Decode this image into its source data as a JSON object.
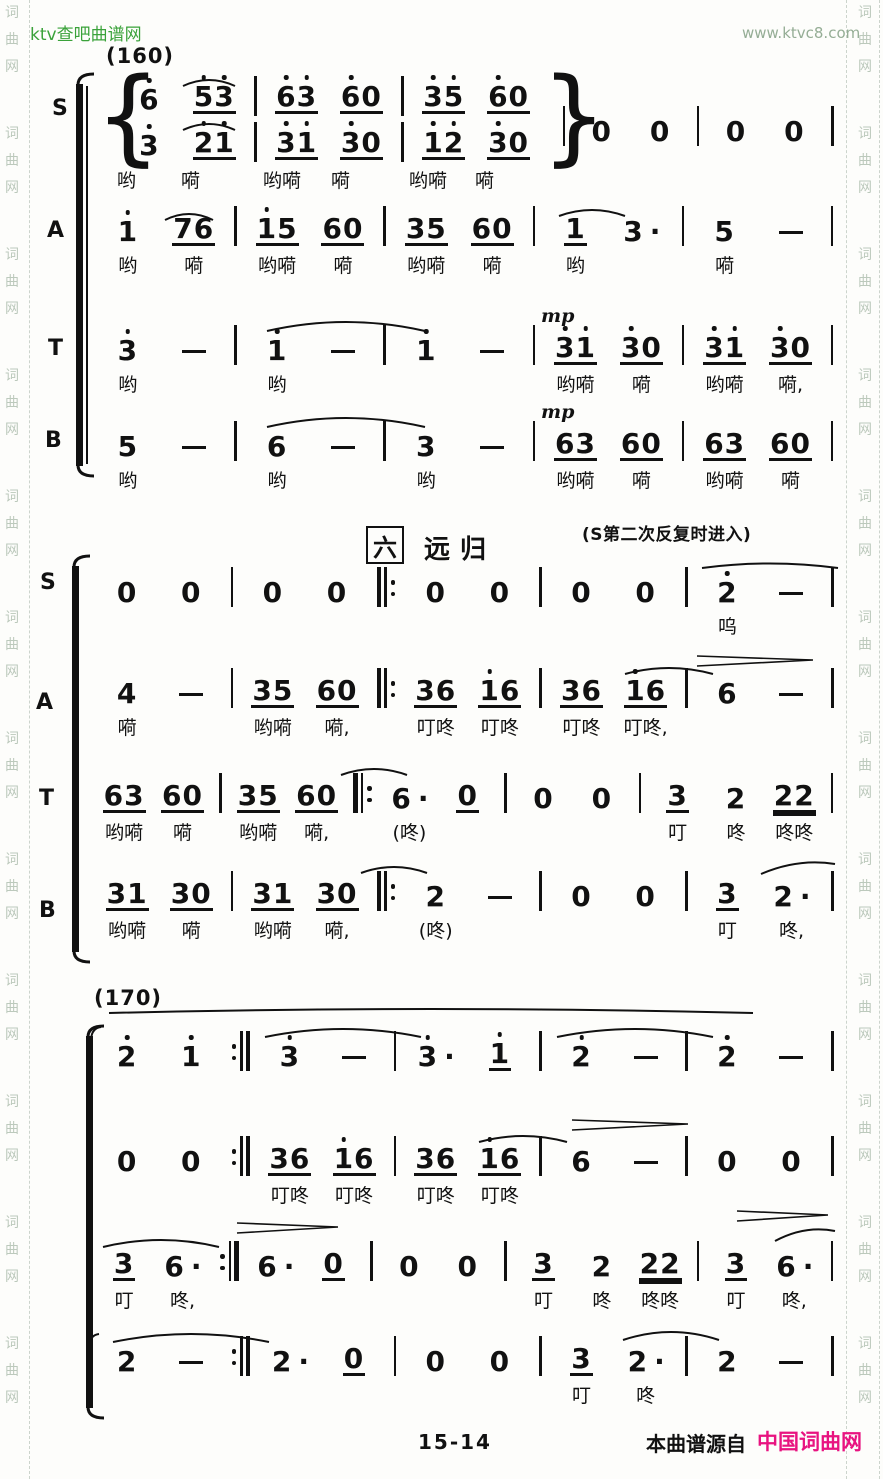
{
  "page": {
    "bg": "#fdfdfb",
    "ink": "#111111",
    "header_green": "#3aa23a",
    "header_sage": "#95ad95",
    "watermark_color": "#bcc9bc",
    "magenta": "#e81380"
  },
  "header": {
    "site_left": "ktv查吧曲谱网",
    "site_right": "www.ktvc8.com"
  },
  "watermark": {
    "chars": [
      "词",
      "曲",
      "网"
    ],
    "groups": 12
  },
  "footer": {
    "page_no": "15-14",
    "source_prefix": "本曲谱源自",
    "source_site": "中国词曲网"
  },
  "dynamics": {
    "mp": "mp"
  },
  "labels": [
    {
      "name": "rehearsal-mark-160",
      "text": "(160)",
      "x": 106,
      "y": 44,
      "cls": "mark"
    },
    {
      "name": "voice-label-s1",
      "text": "S",
      "x": 52,
      "y": 96,
      "cls": "vlabel"
    },
    {
      "name": "voice-label-a1",
      "text": "A",
      "x": 47,
      "y": 218,
      "cls": "vlabel"
    },
    {
      "name": "voice-label-t1",
      "text": "T",
      "x": 48,
      "y": 336,
      "cls": "vlabel"
    },
    {
      "name": "voice-label-b1",
      "text": "B",
      "x": 45,
      "y": 428,
      "cls": "vlabel"
    },
    {
      "name": "section-number-box",
      "text": "六",
      "x": 366,
      "y": 526,
      "cls": "boxed"
    },
    {
      "name": "section-title",
      "text": "远归",
      "x": 424,
      "y": 529,
      "cls": "sect"
    },
    {
      "name": "repeat-annotation",
      "text": "(S第二次反复时进入)",
      "x": 582,
      "y": 520,
      "cls": "annot"
    },
    {
      "name": "voice-label-s2",
      "text": "S",
      "x": 40,
      "y": 570,
      "cls": "vlabel"
    },
    {
      "name": "voice-label-a2",
      "text": "A",
      "x": 36,
      "y": 690,
      "cls": "vlabel"
    },
    {
      "name": "voice-label-t2",
      "text": "T",
      "x": 39,
      "y": 786,
      "cls": "vlabel"
    },
    {
      "name": "voice-label-b2",
      "text": "B",
      "x": 39,
      "y": 898,
      "cls": "vlabel"
    },
    {
      "name": "rehearsal-mark-170",
      "text": "(170)",
      "x": 94,
      "y": 986,
      "cls": "mark"
    }
  ],
  "brackets": [
    {
      "x": 76,
      "y": 84,
      "h": 382,
      "thin": true
    },
    {
      "x": 72,
      "y": 566,
      "h": 386,
      "thin": false
    },
    {
      "x": 86,
      "y": 1036,
      "h": 372,
      "thin": false
    }
  ],
  "divisi": {
    "top": 70,
    "lines": [
      [
        "6'",
        "5'3'_",
        "|",
        "6'3'_",
        "6'0_",
        "|",
        "3'5'_",
        "6'0_"
      ],
      [
        "3'",
        "2'1'_",
        "|",
        "3'1'_",
        "3'0_",
        "|",
        "1'2'_",
        "3'0_"
      ]
    ],
    "after": [
      "|",
      "0",
      "0",
      "|",
      "0",
      "0",
      "|"
    ],
    "lyrics": [
      {
        "x": 0,
        "t": "哟"
      },
      {
        "x": 64,
        "t": "嗬"
      },
      {
        "x": 146,
        "t": "哟嗬"
      },
      {
        "x": 214,
        "t": "嗬"
      },
      {
        "x": 292,
        "t": "哟嗬"
      },
      {
        "x": 358,
        "t": "嗬"
      }
    ],
    "overlays": [
      {
        "type": "tie",
        "x": 64,
        "y": 4,
        "w": 56
      },
      {
        "type": "tie",
        "x": 64,
        "y": 48,
        "w": 56
      }
    ]
  },
  "rows": [
    {
      "voice": "A",
      "top": 200,
      "cells": [
        {
          "t": "1'",
          "l": "哟"
        },
        {
          "t": "76_",
          "l": "嗬"
        },
        {
          "t": "|"
        },
        {
          "t": "1'5_",
          "l": "哟嗬"
        },
        {
          "t": "60_",
          "l": "嗬"
        },
        {
          "t": "|"
        },
        {
          "t": "35_",
          "l": "哟嗬"
        },
        {
          "t": "60_",
          "l": "嗬"
        },
        {
          "t": "|"
        },
        {
          "t": "1_",
          "l": "哟"
        },
        {
          "t": "3."
        },
        {
          "t": "|"
        },
        {
          "t": "5",
          "l": "嗬"
        },
        {
          "t": "-"
        },
        {
          "t": "|"
        }
      ],
      "overlays": [
        {
          "type": "tie",
          "x": 68,
          "y": 8,
          "w": 52
        },
        {
          "type": "tie",
          "x": 462,
          "y": 4,
          "w": 70
        }
      ]
    },
    {
      "voice": "T",
      "top": 319,
      "cells": [
        {
          "t": "3'",
          "l": "哟"
        },
        {
          "t": "-"
        },
        {
          "t": "|"
        },
        {
          "t": "1'",
          "l": "哟"
        },
        {
          "t": "-"
        },
        {
          "t": "|"
        },
        {
          "t": "1'"
        },
        {
          "t": "-"
        },
        {
          "t": "|"
        },
        {
          "t": "3'1'_",
          "l": "哟嗬"
        },
        {
          "t": "3'0_",
          "l": "嗬"
        },
        {
          "t": "|"
        },
        {
          "t": "3'1'_",
          "l": "哟嗬"
        },
        {
          "t": "3'0_",
          "l": "嗬,"
        },
        {
          "t": "|"
        }
      ],
      "overlays": [
        {
          "type": "slur",
          "x": 170,
          "y": -6,
          "w": 162,
          "h": 18
        },
        {
          "type": "mp",
          "x": 446,
          "y": -14
        }
      ]
    },
    {
      "voice": "B",
      "top": 415,
      "cells": [
        {
          "t": "5",
          "l": "哟"
        },
        {
          "t": "-"
        },
        {
          "t": "|"
        },
        {
          "t": "6",
          "l": "哟"
        },
        {
          "t": "-"
        },
        {
          "t": "|"
        },
        {
          "t": "3",
          "l": "哟"
        },
        {
          "t": "-"
        },
        {
          "t": "|"
        },
        {
          "t": "63_",
          "l": "哟嗬"
        },
        {
          "t": "60_",
          "l": "嗬"
        },
        {
          "t": "|"
        },
        {
          "t": "63_",
          "l": "哟嗬"
        },
        {
          "t": "60_",
          "l": "嗬"
        },
        {
          "t": "|"
        }
      ],
      "overlays": [
        {
          "type": "slur",
          "x": 170,
          "y": -6,
          "w": 162,
          "h": 18
        },
        {
          "type": "mp",
          "x": 446,
          "y": -14
        }
      ]
    },
    {
      "voice": "S",
      "top": 561,
      "cells": [
        {
          "t": "0"
        },
        {
          "t": "0"
        },
        {
          "t": "|"
        },
        {
          "t": "0"
        },
        {
          "t": "0"
        },
        {
          "t": "|:"
        },
        {
          "t": "0"
        },
        {
          "t": "0"
        },
        {
          "t": "|"
        },
        {
          "t": "0"
        },
        {
          "t": "0"
        },
        {
          "t": "|"
        },
        {
          "t": "2'",
          "l": "呜"
        },
        {
          "t": "-"
        },
        {
          "t": "|"
        }
      ],
      "overlays": [
        {
          "type": "flat",
          "x": 605,
          "y": -2,
          "w": 140,
          "h": 9
        }
      ]
    },
    {
      "voice": "A",
      "top": 662,
      "cells": [
        {
          "t": "4",
          "l": "嗬"
        },
        {
          "t": "-"
        },
        {
          "t": "|"
        },
        {
          "t": "35_",
          "l": "哟嗬"
        },
        {
          "t": "60_",
          "l": "嗬,"
        },
        {
          "t": "|:"
        },
        {
          "t": "36_",
          "l": "叮咚"
        },
        {
          "t": "1'6_",
          "l": "叮咚"
        },
        {
          "t": "|"
        },
        {
          "t": "36_",
          "l": "叮咚"
        },
        {
          "t": "1'6_",
          "l": "叮咚,"
        },
        {
          "t": "|"
        },
        {
          "t": "6"
        },
        {
          "t": "-"
        },
        {
          "t": "|"
        }
      ],
      "overlays": [
        {
          "type": "tie",
          "x": 528,
          "y": 0,
          "w": 92
        },
        {
          "type": "hpin",
          "x": 600,
          "y": -8,
          "w": 120
        }
      ]
    },
    {
      "voice": "T",
      "top": 767,
      "cells": [
        {
          "t": "63_",
          "l": "哟嗬"
        },
        {
          "t": "60_",
          "l": "嗬"
        },
        {
          "t": "|"
        },
        {
          "t": "35_",
          "l": "哟嗬"
        },
        {
          "t": "60_",
          "l": "嗬,"
        },
        {
          "t": "|:"
        },
        {
          "t": "6.",
          "l": "(咚)"
        },
        {
          "t": "0_"
        },
        {
          "t": "|"
        },
        {
          "t": "0"
        },
        {
          "t": "0"
        },
        {
          "t": "|"
        },
        {
          "t": "3_",
          "l": "叮"
        },
        {
          "t": "2",
          "l": "咚"
        },
        {
          "t": "22__",
          "l": "咚咚"
        },
        {
          "t": "|"
        }
      ],
      "overlays": [
        {
          "type": "slur",
          "x": 244,
          "y": -4,
          "w": 70,
          "h": 12
        }
      ]
    },
    {
      "voice": "B",
      "top": 865,
      "cells": [
        {
          "t": "31_",
          "l": "哟嗬"
        },
        {
          "t": "30_",
          "l": "嗬"
        },
        {
          "t": "|"
        },
        {
          "t": "31_",
          "l": "哟嗬"
        },
        {
          "t": "30_",
          "l": "嗬,"
        },
        {
          "t": "|:"
        },
        {
          "t": "2",
          "l": "(咚)"
        },
        {
          "t": "-"
        },
        {
          "t": "|"
        },
        {
          "t": "0"
        },
        {
          "t": "0"
        },
        {
          "t": "|"
        },
        {
          "t": "3_",
          "l": "叮"
        },
        {
          "t": "2.",
          "l": "咚,"
        },
        {
          "t": "|"
        }
      ],
      "overlays": [
        {
          "type": "slur",
          "x": 264,
          "y": -4,
          "w": 70,
          "h": 12
        },
        {
          "type": "rslur",
          "x": 664,
          "y": -7,
          "w": 78,
          "rise": 10
        }
      ]
    },
    {
      "voice": "S",
      "top": 1025,
      "cells": [
        {
          "t": "2'"
        },
        {
          "t": "1'"
        },
        {
          "t": ":|"
        },
        {
          "t": "3'"
        },
        {
          "t": "-"
        },
        {
          "t": "|"
        },
        {
          "t": "3'."
        },
        {
          "t": "1'_"
        },
        {
          "t": "|"
        },
        {
          "t": "2'"
        },
        {
          "t": "-"
        },
        {
          "t": "|"
        },
        {
          "t": "2'"
        },
        {
          "t": "-"
        },
        {
          "t": "|"
        }
      ],
      "overlays": [
        {
          "type": "hook",
          "x": -6,
          "y": 0
        },
        {
          "type": "flat",
          "x": 12,
          "y": -20,
          "w": 648,
          "h": 8
        },
        {
          "type": "slur",
          "x": 168,
          "y": -4,
          "w": 160,
          "h": 16
        },
        {
          "type": "slur",
          "x": 460,
          "y": -4,
          "w": 160,
          "h": 16
        }
      ]
    },
    {
      "voice": "A",
      "top": 1130,
      "cells": [
        {
          "t": "0"
        },
        {
          "t": "0"
        },
        {
          "t": ":|"
        },
        {
          "t": "36_",
          "l": "叮咚"
        },
        {
          "t": "1'6_",
          "l": "叮咚"
        },
        {
          "t": "|"
        },
        {
          "t": "36_",
          "l": "叮咚"
        },
        {
          "t": "1'6_",
          "l": "叮咚"
        },
        {
          "t": "|"
        },
        {
          "t": "6"
        },
        {
          "t": "-"
        },
        {
          "t": "|"
        },
        {
          "t": "0"
        },
        {
          "t": "0"
        },
        {
          "t": "|"
        }
      ],
      "overlays": [
        {
          "type": "tie",
          "x": 382,
          "y": 0,
          "w": 92
        },
        {
          "type": "hpin",
          "x": 475,
          "y": -12,
          "w": 120
        }
      ]
    },
    {
      "voice": "T",
      "top": 1235,
      "cells": [
        {
          "t": "3_",
          "l": "叮"
        },
        {
          "t": "6.",
          "l": "咚,"
        },
        {
          "t": ":|"
        },
        {
          "t": "6."
        },
        {
          "t": "0_"
        },
        {
          "t": "|"
        },
        {
          "t": "0"
        },
        {
          "t": "0"
        },
        {
          "t": "|"
        },
        {
          "t": "3_",
          "l": "叮"
        },
        {
          "t": "2",
          "l": "咚"
        },
        {
          "t": "22__",
          "l": "咚咚"
        },
        {
          "t": "|"
        },
        {
          "t": "3_",
          "l": "叮"
        },
        {
          "t": "6.",
          "l": "咚,"
        },
        {
          "t": "|"
        }
      ],
      "overlays": [
        {
          "type": "slur",
          "x": 6,
          "y": -2,
          "w": 120,
          "h": 14
        },
        {
          "type": "hpin",
          "x": 140,
          "y": -14,
          "w": 105
        },
        {
          "type": "hpin",
          "x": 640,
          "y": -26,
          "w": 95
        },
        {
          "type": "rslur",
          "x": 678,
          "y": -10,
          "w": 64,
          "rise": 10
        }
      ]
    },
    {
      "voice": "B",
      "top": 1330,
      "cells": [
        {
          "t": "2"
        },
        {
          "t": "-"
        },
        {
          "t": ":|"
        },
        {
          "t": "2."
        },
        {
          "t": "0_"
        },
        {
          "t": "|"
        },
        {
          "t": "0"
        },
        {
          "t": "0"
        },
        {
          "t": "|"
        },
        {
          "t": "3_",
          "l": "叮"
        },
        {
          "t": "2.",
          "l": "咚"
        },
        {
          "t": "|"
        },
        {
          "t": "2"
        },
        {
          "t": "-"
        },
        {
          "t": "|"
        }
      ],
      "overlays": [
        {
          "type": "hook",
          "x": -8,
          "y": 2
        },
        {
          "type": "slur",
          "x": 16,
          "y": -4,
          "w": 160,
          "h": 16
        },
        {
          "type": "slur",
          "x": 526,
          "y": -6,
          "w": 100,
          "h": 16
        }
      ]
    }
  ]
}
